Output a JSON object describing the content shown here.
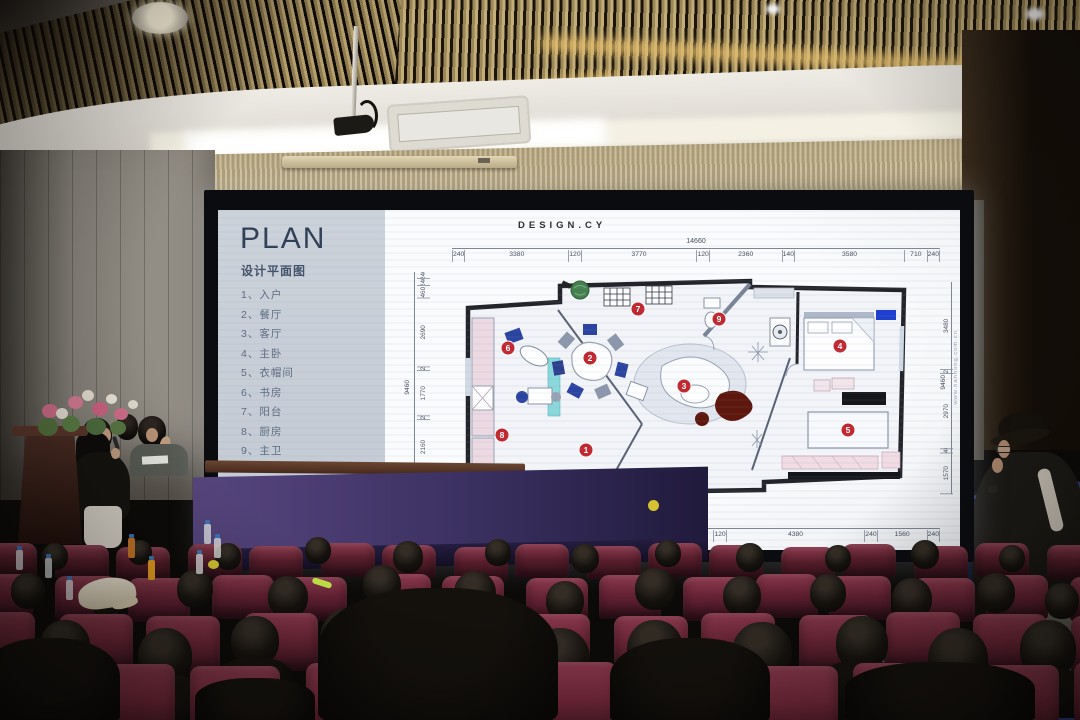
{
  "slide": {
    "title": "PLAN",
    "subtitle": "设计平面图",
    "rooms": [
      "1、入户",
      "2、餐厅",
      "3、客厅",
      "4、主卧",
      "5、衣帽间",
      "6、书房",
      "7、阳台",
      "8、厨房",
      "9、主卫"
    ],
    "brand": "DESIGN.CY",
    "dims": {
      "top_total": "14660",
      "top": [
        "240",
        "3380",
        "120",
        "3770",
        "120",
        "2360",
        "140",
        "3580",
        "710",
        "240"
      ],
      "left_total": "9460",
      "left": [
        "240",
        "240",
        "460",
        "2690",
        "120",
        "1770",
        "120",
        "2160",
        "240",
        "1180",
        "240"
      ],
      "right": [
        "3480",
        "120",
        "2970",
        "140",
        "1570"
      ],
      "right_total": "9460",
      "bottom": [
        "240",
        "920",
        "240",
        "2140",
        "4380",
        "120",
        "4380",
        "240",
        "1560",
        "240"
      ],
      "website": "www.nanhong.com.cn"
    },
    "markers": [
      "1",
      "2",
      "3",
      "4",
      "5",
      "6",
      "7",
      "8",
      "9"
    ]
  },
  "watermark": {
    "title": "南鸿设计新室力",
    "subtitle": "NEW INTERIOR DESIGN"
  },
  "colors": {
    "marker_red": "#c22730",
    "chair_maroon": "#6f2638",
    "slide_bg": "#f7f8fa",
    "accent_blue": "#2b44a1"
  }
}
